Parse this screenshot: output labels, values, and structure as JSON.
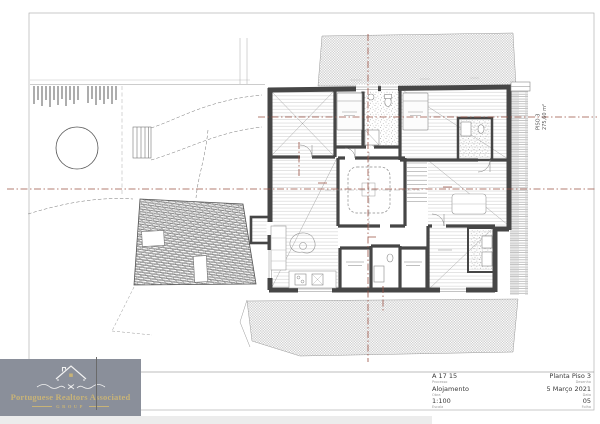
{
  "drawing": {
    "floor_label": "PISO 3",
    "floor_area": "275,60 m²"
  },
  "logo": {
    "name": "Portuguese Realtors Associated",
    "group_label": "GROUP",
    "background": "#8A8F9A",
    "gold": "#C8B377"
  },
  "title_block": {
    "left": [
      {
        "value": "A 17 15",
        "label": "Processo"
      },
      {
        "value": "Alojamento",
        "label": "Obra"
      },
      {
        "value": "1:100",
        "label": "Escala"
      }
    ],
    "right": [
      {
        "value": "Planta Piso 3",
        "label": "Desenho"
      },
      {
        "value": "5 Março 2021",
        "label": "Data"
      },
      {
        "value": "05",
        "label": "Folha"
      }
    ]
  }
}
